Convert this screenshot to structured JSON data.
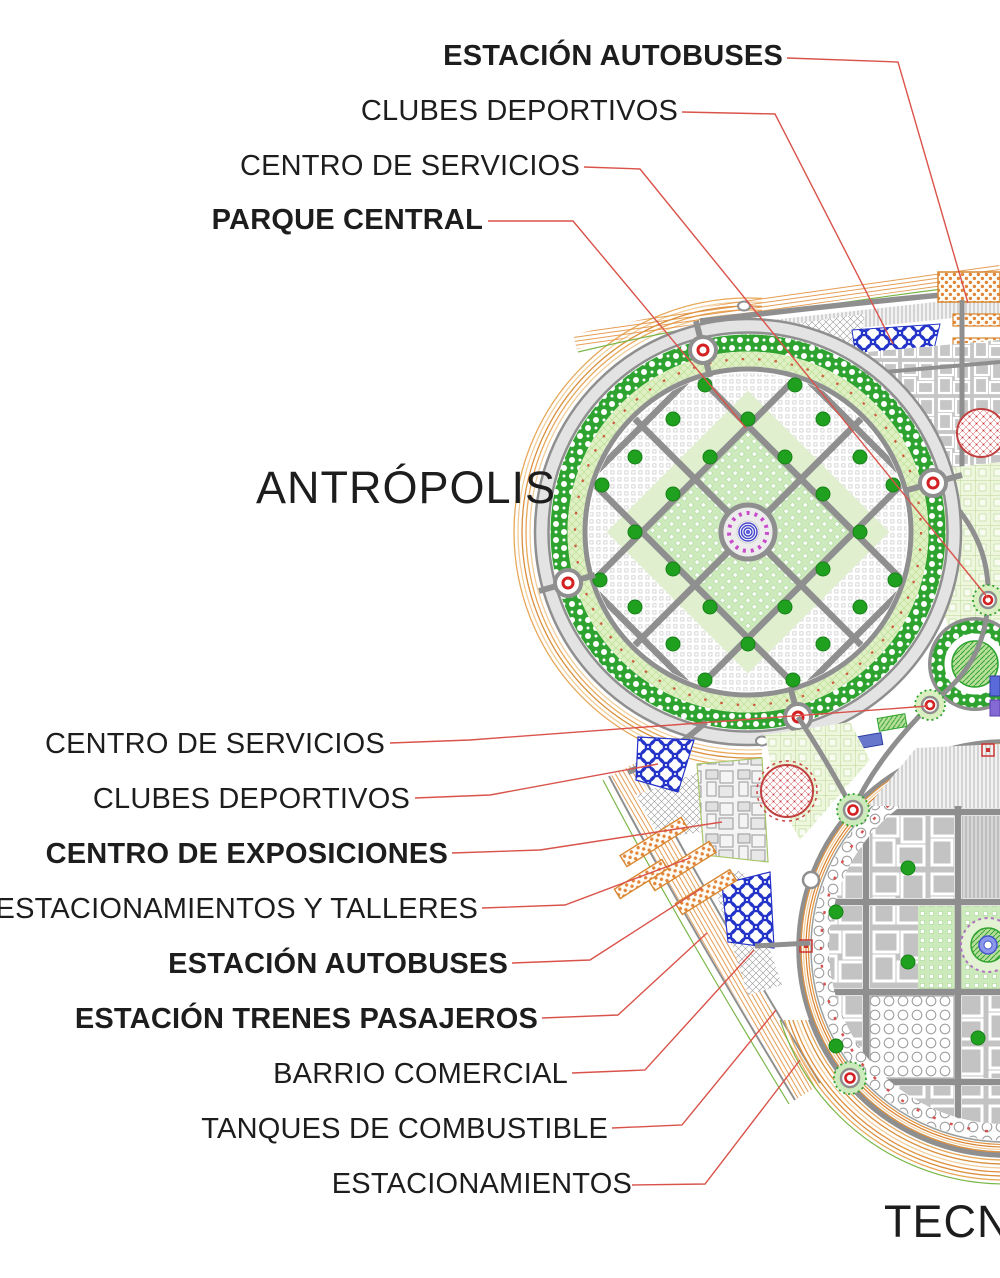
{
  "districts": {
    "left": "ANTRÓPOLIS",
    "right": "TECNÓPOLIS"
  },
  "callouts_top": [
    {
      "text": "ESTACIÓN AUTOBUSES",
      "bold": true
    },
    {
      "text": "CLUBES DEPORTIVOS",
      "bold": false
    },
    {
      "text": "CENTRO DE SERVICIOS",
      "bold": false
    },
    {
      "text": "PARQUE CENTRAL",
      "bold": true
    }
  ],
  "callouts_left": [
    {
      "text": "CENTRO DE SERVICIOS",
      "bold": false
    },
    {
      "text": "CLUBES DEPORTIVOS",
      "bold": false
    },
    {
      "text": "CENTRO DE EXPOSICIONES",
      "bold": true
    },
    {
      "text": "ESTACIONAMIENTOS Y TALLERES",
      "bold": false
    },
    {
      "text": "ESTACIÓN AUTOBUSES",
      "bold": true
    },
    {
      "text": "ESTACIÓN TRENES PASAJEROS",
      "bold": true
    },
    {
      "text": "BARRIO COMERCIAL",
      "bold": false
    },
    {
      "text": "TANQUES DE COMBUSTIBLE",
      "bold": false
    },
    {
      "text": "ESTACIONAMIENTOS",
      "bold": false
    }
  ],
  "palette": {
    "leader_red": "#d9534a",
    "road_gray": "#8f8f8f",
    "tree_green": "#1fa11f",
    "band_green": "#2fa32f",
    "light_green": "#dff0c3",
    "boundary_orange": "#e2923f",
    "sports_blue": "#2433c8",
    "arena_red": "#c04040",
    "plaza_violet": "#b070c0",
    "text_dark": "#1d1d1d"
  }
}
